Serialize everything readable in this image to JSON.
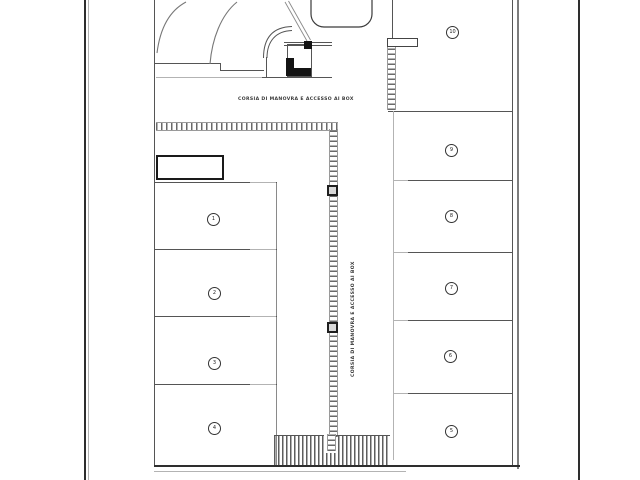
{
  "plan": {
    "aisle_label_top": "CORSIA DI MANOVRA E ACCESSO AI BOX",
    "aisle_label_center": "CORSIA DI MANOVRA E ACCESSO AI BOX",
    "left_boxes": [
      {
        "number": "1"
      },
      {
        "number": "2"
      },
      {
        "number": "3"
      },
      {
        "number": "4"
      }
    ],
    "right_boxes": [
      {
        "number": "9"
      },
      {
        "number": "8"
      },
      {
        "number": "7"
      },
      {
        "number": "6"
      },
      {
        "number": "5"
      }
    ],
    "top_right_box": {
      "number": "10"
    },
    "colors": {
      "wall_line": "#555555",
      "light_line": "#b3b3b3",
      "hatch": "#6a6a6a",
      "structure_black": "#141414",
      "sheet_border": "#333333",
      "background": "#ffffff"
    }
  }
}
